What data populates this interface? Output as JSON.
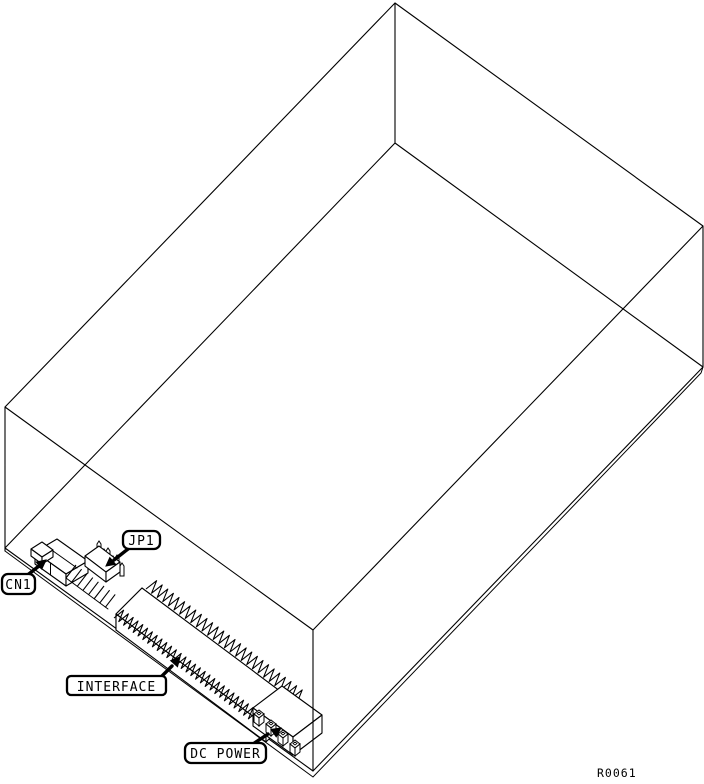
{
  "diagram": {
    "callouts": {
      "cn1": "CN1",
      "jp1": "JP1",
      "interface": "INTERFACE",
      "dc_power": "DC POWER"
    },
    "drawing_ref": "R0061",
    "colors": {
      "line": "#000000",
      "background": "#ffffff"
    }
  }
}
